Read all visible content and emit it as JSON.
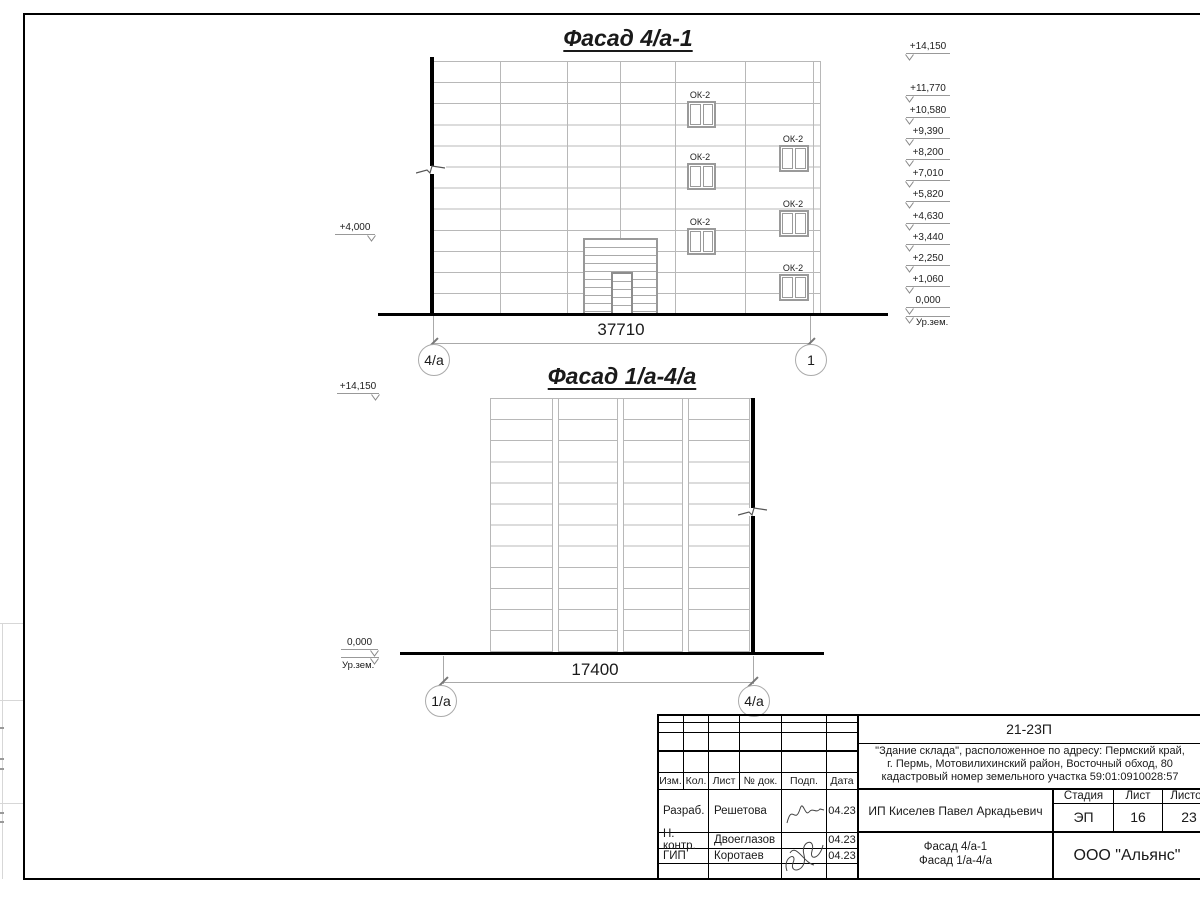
{
  "facade1": {
    "title": "Фасад 4/а-1",
    "window_label": "ОК-2",
    "left_level": "+4,000",
    "levels": [
      "+14,150",
      "+11,770",
      "+10,580",
      "+9,390",
      "+8,200",
      "+7,010",
      "+5,820",
      "+4,630",
      "+3,440",
      "+2,250",
      "+1,060",
      "0,000"
    ],
    "ground_label": "Ур.зем.",
    "dim": "37710",
    "axis_left": "4/а",
    "axis_right": "1"
  },
  "facade2": {
    "title": "Фасад 1/а-4/а",
    "top_level": "+14,150",
    "zero_level": "0,000",
    "ground_label": "Ур.зем.",
    "dim": "17400",
    "axis_left": "1/а",
    "axis_right": "4/а"
  },
  "titleblock": {
    "doc_number": "21-23П",
    "project_lines": [
      "\"Здание склада\", расположенное по адресу: Пермский край,",
      "г. Пермь, Мотовилихинский район, Восточный обход, 80",
      "кадастровый номер земельного участка 59:01:0910028:57"
    ],
    "cols": {
      "izm": "Изм.",
      "kol": "Кол.",
      "list": "Лист",
      "ndok": "№ док.",
      "podp": "Подп.",
      "data": "Дата"
    },
    "rows": [
      {
        "role": "Разраб.",
        "name": "Решетова",
        "date": "04.23"
      },
      {
        "role": "Н. контр.",
        "name": "Двоеглазов",
        "date": "04.23"
      },
      {
        "role": "ГИП",
        "name": "Коротаев",
        "date": "04.23"
      }
    ],
    "client": "ИП Киселев Павел Аркадьевич",
    "stage_label": "Стадия",
    "sheet_label": "Лист",
    "sheets_label": "Листов",
    "stage": "ЭП",
    "sheet_no": "16",
    "sheets_total": "23",
    "drawing_lines": [
      "Фасад 4/а-1",
      "Фасад 1/а-4/а"
    ],
    "company": "ООО \"Альянс\""
  }
}
